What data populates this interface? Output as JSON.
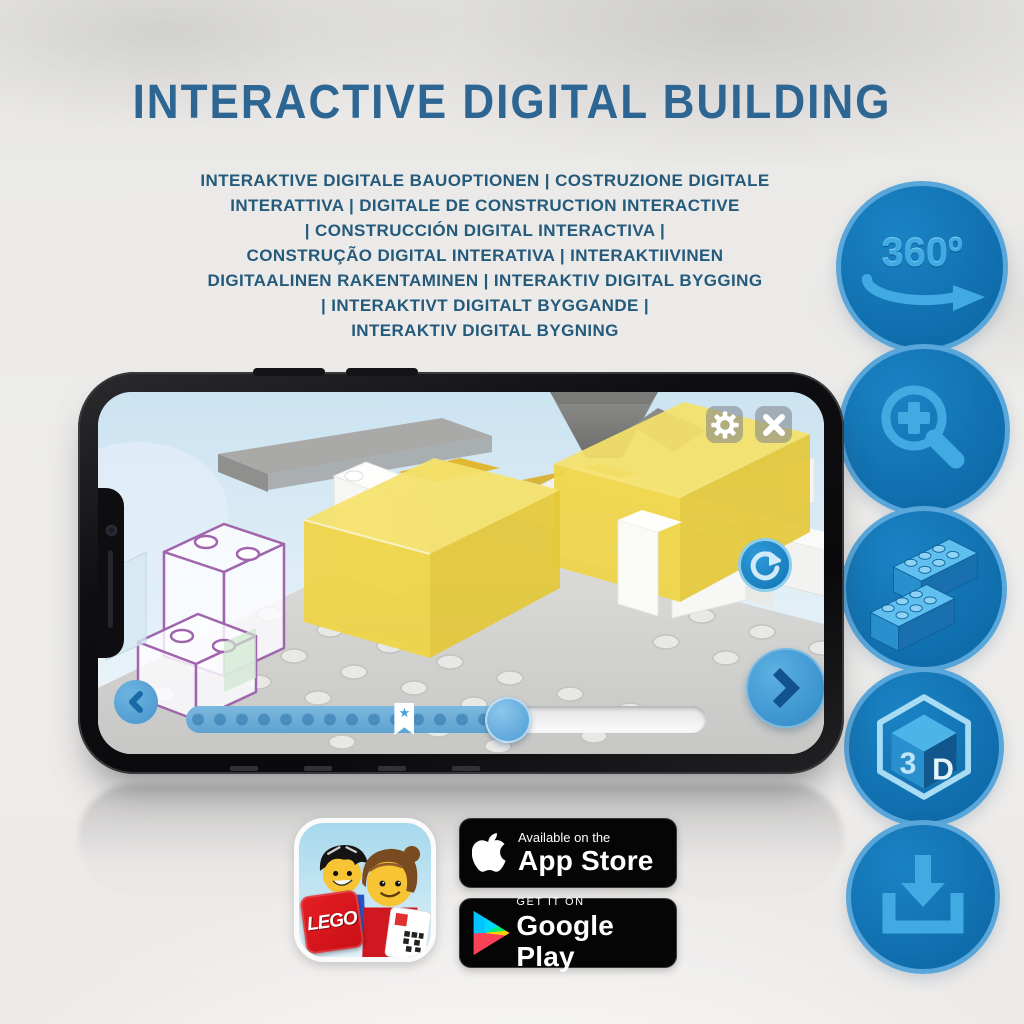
{
  "title": "INTERACTIVE DIGITAL BUILDING",
  "subtitle": {
    "lines": [
      "INTERAKTIVE DIGITALE BAUOPTIONEN | COSTRUZIONE DIGITALE",
      "INTERATTIVA | DIGITALE DE CONSTRUCTION INTERACTIVE",
      "| CONSTRUCCIÓN DIGITAL INTERACTIVA |",
      "CONSTRUÇÃO DIGITAL INTERATIVA | INTERAKTIIVINEN",
      "DIGITAALINEN RAKENTAMINEN | INTERAKTIV DIGITAL BYGGING",
      "| INTERAKTIVT DIGITALT BYGGANDE |",
      "INTERAKTIV DIGITAL BYGNING"
    ]
  },
  "feature_rail": {
    "items": [
      {
        "id": "rotate-360",
        "label": "360º"
      },
      {
        "id": "zoom-in",
        "label": ""
      },
      {
        "id": "brick-building-steps",
        "label": ""
      },
      {
        "id": "view-3d",
        "label_left": "3",
        "label_right": "D"
      },
      {
        "id": "download-instructions",
        "label": ""
      }
    ]
  },
  "phone": {
    "slider": {
      "progress_percent": 62,
      "star_percent": 42,
      "star_glyph": "★"
    }
  },
  "store_badges": {
    "app_store": {
      "tagline": "Available on the",
      "store": "App Store"
    },
    "google_play": {
      "tagline": "GET IT ON",
      "store": "Google Play"
    },
    "lego_app": {
      "logo_text": "LEGO"
    }
  },
  "colors": {
    "title_blue": "#2d6593",
    "subtitle_blue": "#245a7b",
    "circle_fill": "#0f6cab",
    "circle_ring": "#58a6da",
    "glyph_blue": "#41aae2",
    "screen_sky": "#d3e7f3",
    "control_blue": "#4aa0d8",
    "yellow_brick": "#f0d545",
    "badge_black": "#050505"
  }
}
